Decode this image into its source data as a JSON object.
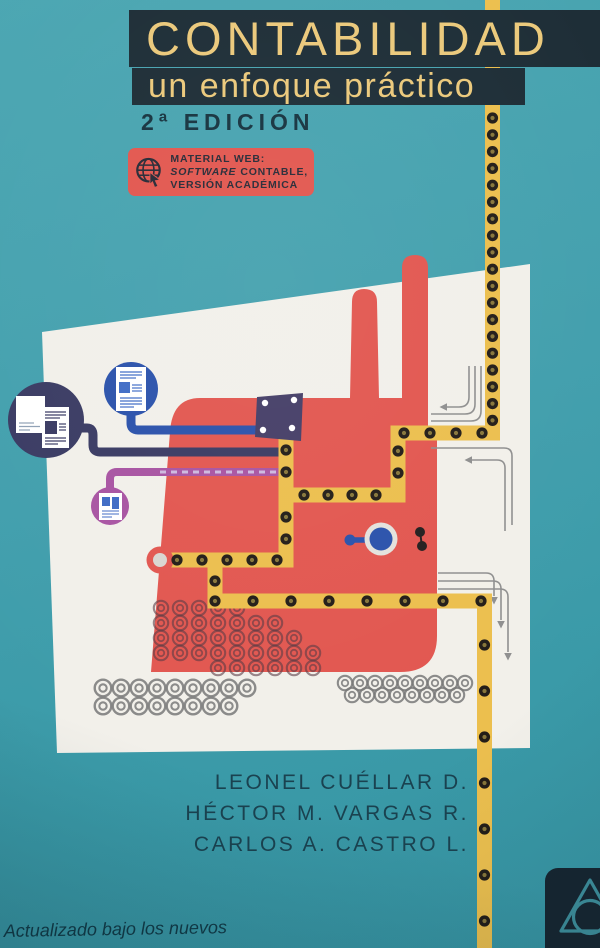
{
  "book_cover": {
    "title": "CONTABILIDAD",
    "subtitle": "un enfoque práctico",
    "edition": "2ª EDICIÓN",
    "web_badge": {
      "icon": "globe-cursor-icon",
      "line1": "MATERIAL WEB:",
      "line2_em": "SOFTWARE",
      "line2_rest": "CONTABLE,",
      "line3": "VERSIÓN ACADÉMICA"
    },
    "authors": [
      "LEONEL CUÉLLAR D.",
      "HÉCTOR M. VARGAS R.",
      "CARLOS A. CASTRO L."
    ],
    "bottom_note": "Actualizado bajo los nuevos",
    "publisher_logo": "triangle-circle-logo",
    "colors": {
      "background_teal": "#429fad",
      "band_navy": "#1d2d36",
      "title_yellow": "#ebc97b",
      "pipeline_yellow": "#ecbf4e",
      "badge_red": "#e2574f",
      "factory_red": "#e25750",
      "indigo": "#3a3b63",
      "blue": "#2b52ab",
      "magenta": "#a854a2",
      "author_text": "#1a4250"
    }
  }
}
